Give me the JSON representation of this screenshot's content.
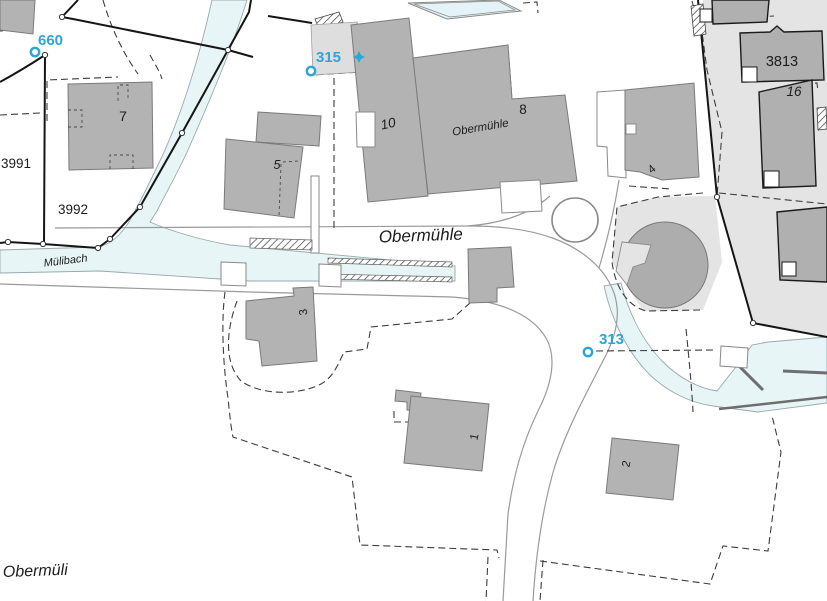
{
  "map": {
    "labels": {
      "street": "Obermühle",
      "building_name": "Obermühle",
      "stream": "Mülibach",
      "locality": "Obermüli",
      "parcel_3991": "3991",
      "parcel_3992": "3992",
      "parcel_3813": "3813",
      "house_7": "7",
      "house_5": "5",
      "house_10": "10",
      "house_8": "8",
      "house_16": "16",
      "house_4": "4",
      "house_3": "3",
      "house_1": "1",
      "house_2": "2"
    },
    "survey_points": {
      "p660": "660",
      "p315": "315",
      "p313": "313"
    },
    "colors": {
      "building_fill": "#b3b3b3",
      "building_stroke": "#7a7a7a",
      "zone_fill": "#e4e4e4",
      "water_fill": "#e7f5f7",
      "water_stroke": "#98aaac",
      "marker_blue": "#29a7d8",
      "boundary_black": "#151515",
      "road_edge": "#9a9a9a"
    }
  }
}
